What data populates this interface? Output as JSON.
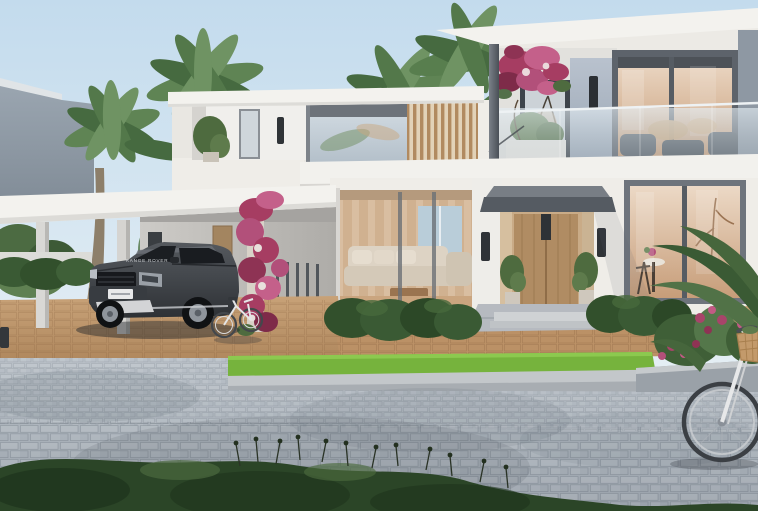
{
  "image": {
    "kind": "architectural-exterior-rendering",
    "caption": "Modern white two-storey villa with cantilevered flat roofs, glass balcony, covered carport with dark grey SUV, bougainvillea-covered column, two white bicycles, clipped hedges, grass verge and cobblestone street"
  },
  "vehicle": {
    "badge_text": "RANGE ROVER"
  },
  "scene": {
    "elements": [
      "sky",
      "neighbor-building",
      "palm-trees",
      "villa",
      "carport",
      "suv",
      "entrance-door",
      "balcony",
      "bougainvillea",
      "hedges",
      "grass-strip",
      "sidewalk",
      "street",
      "small-bicycle",
      "large-bicycle",
      "flower-bed",
      "foreground-shrubs"
    ]
  },
  "colors": {
    "sky-top": "#c3dbed",
    "sky-bottom": "#e7f0f5",
    "wall-white": "#efede8",
    "wall-bright": "#f6f4ef",
    "wall-shade": "#d9d7d3",
    "roof-white": "#f3f2ee",
    "roof-underside": "#99a1aa",
    "neighbor-wall": "#97a2ad",
    "neighbor-wall-dark": "#828d98",
    "panel-blue": "#aeb9c6",
    "steel-dark": "#4e545b",
    "frame-dark": "#3e444b",
    "frame-mid": "#6e747c",
    "glass-warm": "#d9b896",
    "glass-warm-light": "#ecd9c6",
    "glass-cool": "#cfd8df",
    "wood-louver": "#b18a60",
    "wood-door": "#b08c63",
    "wood-light": "#e2d2b8",
    "canopy-gray": "#555b62",
    "sconce-black": "#2f3337",
    "palm-green": "#5f8454",
    "palm-dark": "#466a40",
    "palm-light": "#6f9363",
    "palm-trunk": "#8d7f6a",
    "hedge-green": "#32502c",
    "hedge-light": "#47693c",
    "grass-green": "#76b33d",
    "grass-light": "#8cc94f",
    "tan-paver": "#c49d74",
    "tan-dark": "#a87f50",
    "street-light": "#b6bdc4",
    "street-dark": "#9ba3ac",
    "curb-gray": "#c3c7ca",
    "shrub-dark": "#2b4527",
    "shrub-deep": "#1e331c",
    "bougainvillea": "#a63d62",
    "bougainvillea-light": "#c4608a",
    "bougainvillea-deep": "#7e2b49",
    "flower-magenta": "#b2507a",
    "car-body": "#44484d",
    "car-dark": "#2c2f33",
    "car-glass": "#1b1e22",
    "car-trim": "#d3d4d6",
    "bike-white": "#e7e8e9",
    "bike-dark": "#3b3f44",
    "basket-tan": "#c39a6b"
  }
}
